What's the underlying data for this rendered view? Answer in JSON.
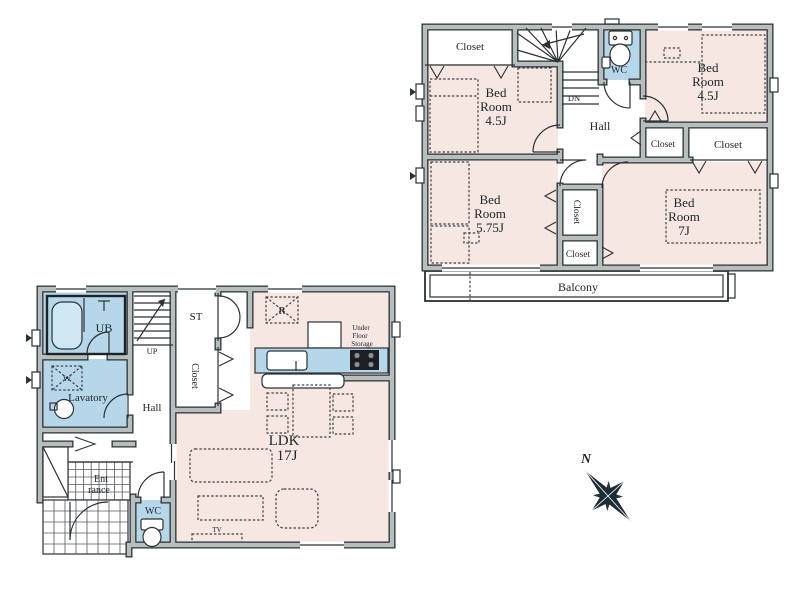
{
  "floor2": {
    "closet_top_left": "Closet",
    "wc": "WC",
    "dn": "DN",
    "hall": "Hall",
    "bedroom_top_left": {
      "l1": "Bed",
      "l2": "Room",
      "l3": "4.5J"
    },
    "bedroom_top_right": {
      "l1": "Bed",
      "l2": "Room",
      "l3": "4.5J"
    },
    "bedroom_bottom_left": {
      "l1": "Bed",
      "l2": "Room",
      "l3": "5.75J"
    },
    "bedroom_bottom_right": {
      "l1": "Bed",
      "l2": "Room",
      "l3": "7J"
    },
    "closet_mid_small": "Closet",
    "closet_mid_large": "Closet",
    "closet_tall": "Closet",
    "closet_bottom": "Closet",
    "balcony": "Balcony"
  },
  "floor1": {
    "ub": "UB",
    "lavatory": "Lavatory",
    "washer": "W",
    "up": "UP",
    "hall": "Hall",
    "storage_st": "ST",
    "closet": "Closet",
    "fridge": "R",
    "ufs": {
      "l1": "Under",
      "l2": "Floor",
      "l3": "Storage"
    },
    "ldk": {
      "l1": "LDK",
      "l2": "17J"
    },
    "entrance": {
      "l1": "Ent",
      "l2": "rance"
    },
    "wc": "WC",
    "tv": "TV"
  },
  "compass": {
    "north": "N"
  },
  "colors": {
    "room_pink": "#f7e7e2",
    "wet_blue": "#b6d7ea",
    "wall_gray": "#b7bfbe",
    "wall_dark": "#2b3134"
  }
}
